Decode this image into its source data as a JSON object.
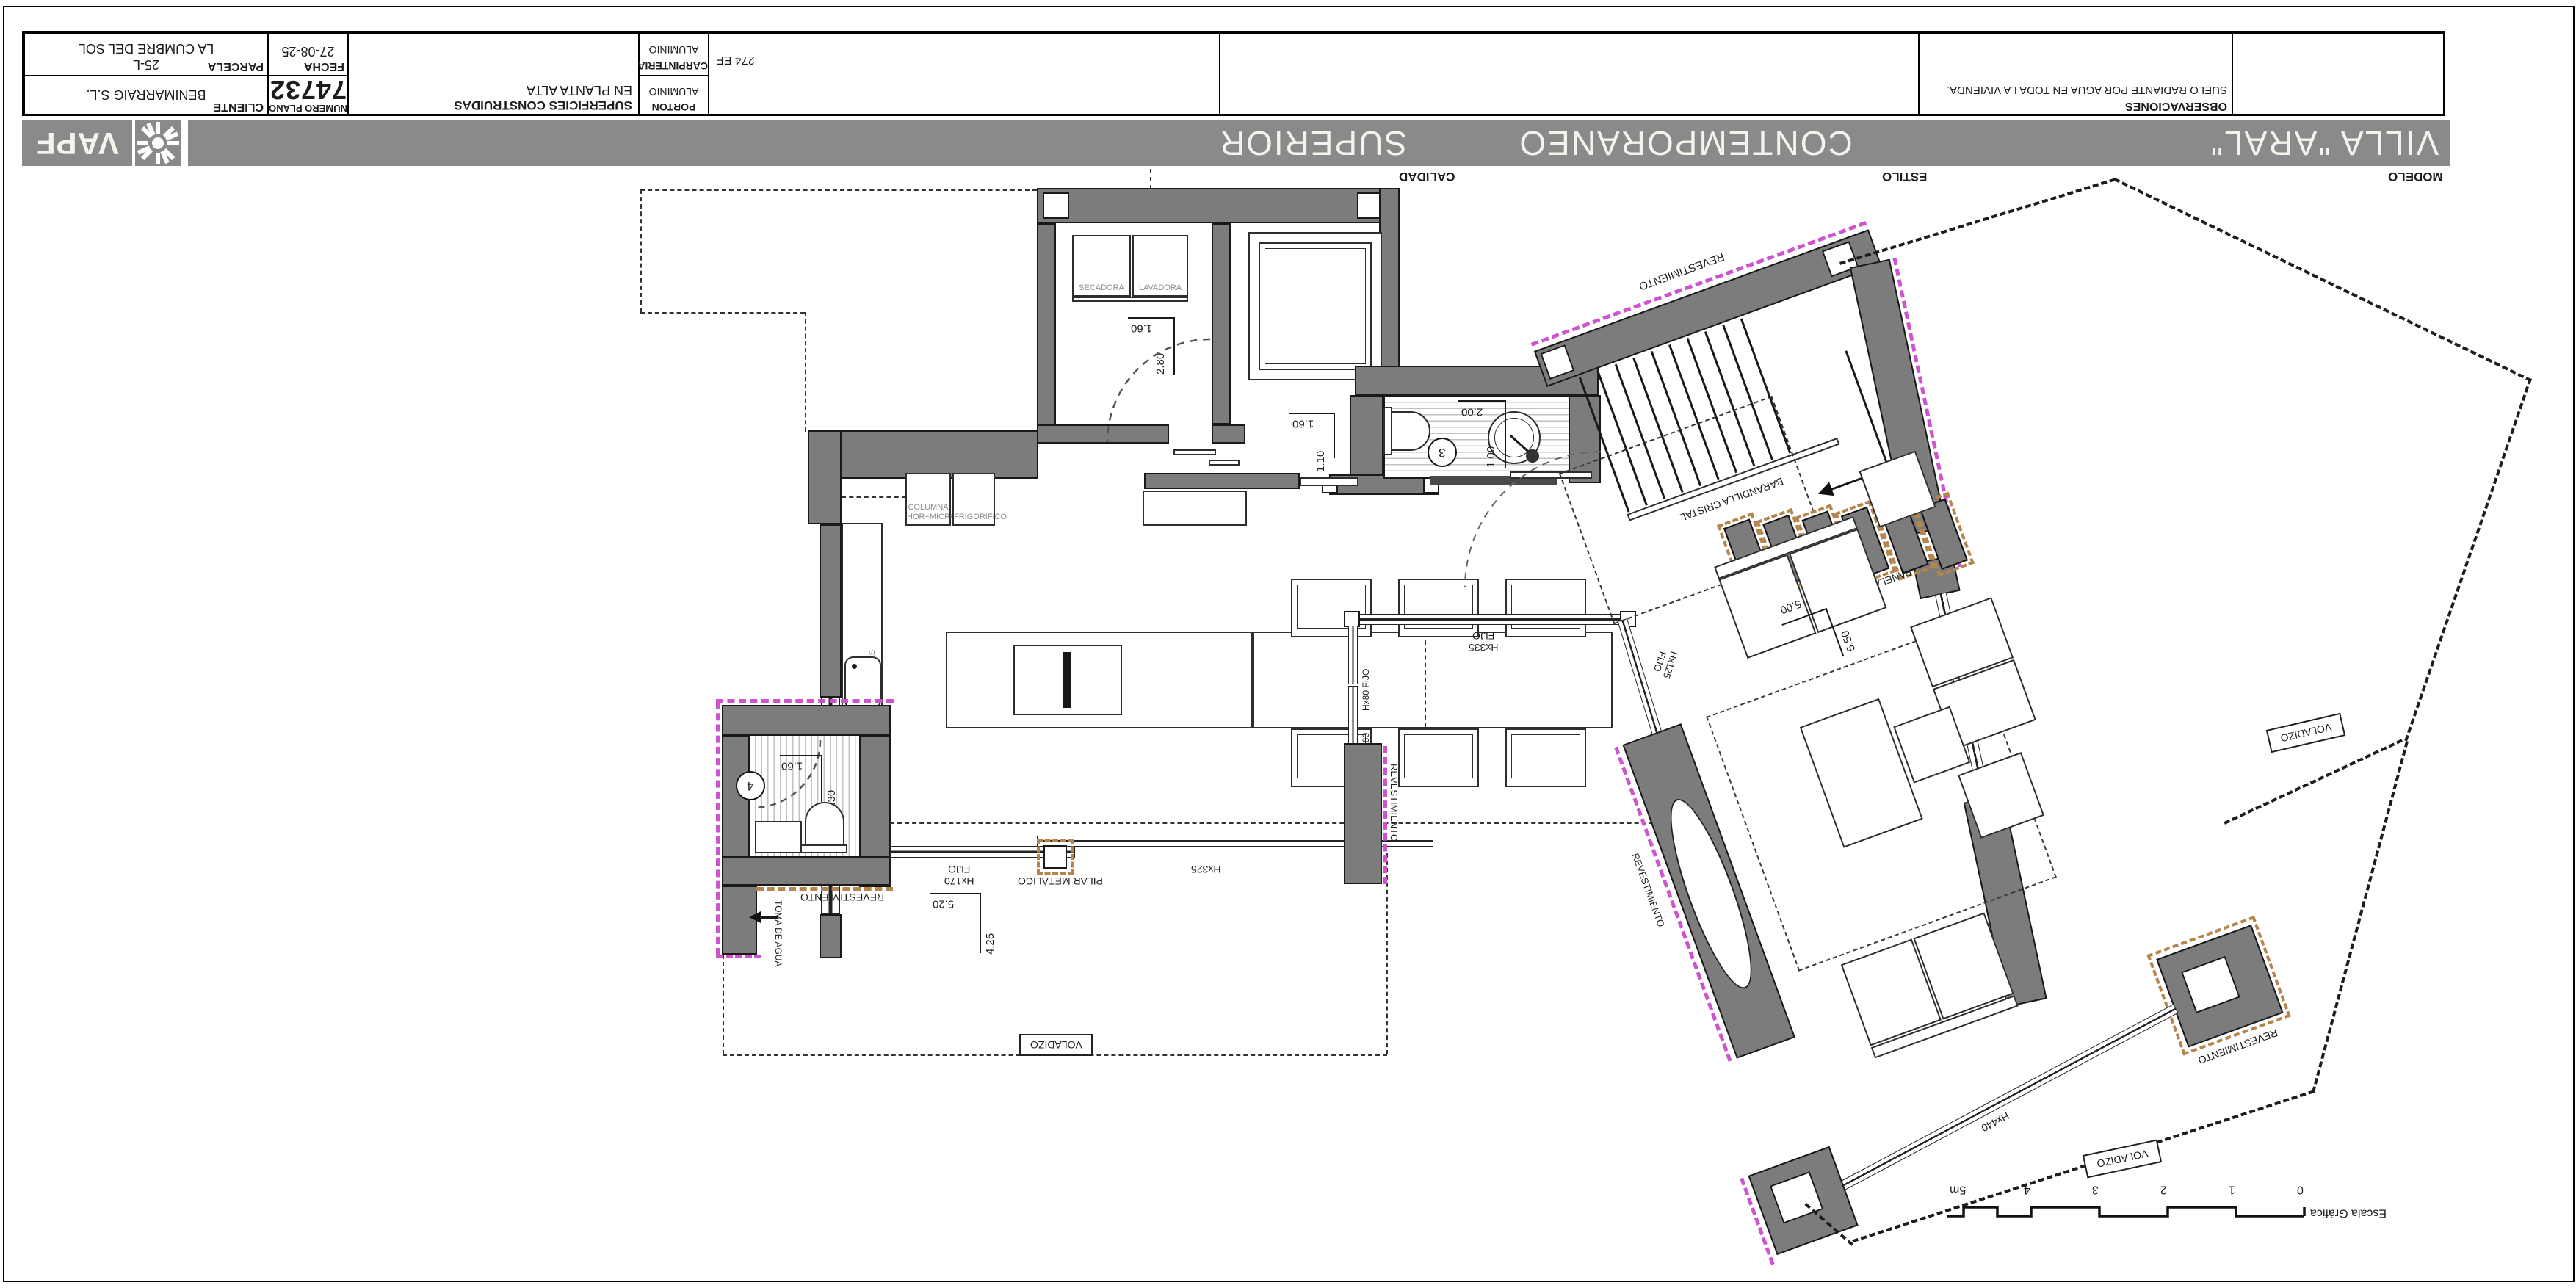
{
  "title_block": {
    "parcela": {
      "label": "PARCELA",
      "line1": "LA CUMBRE DEL SOL",
      "line2": "25-L"
    },
    "fecha": {
      "label": "FECHA",
      "value": "27-08-25"
    },
    "cliente": {
      "label": "CLIENTE",
      "value": "BENIMARRAIG S.L."
    },
    "numero_plano": {
      "label": "NUMERO PLANO",
      "value": "74732"
    },
    "superficies": {
      "line1": "SUPERFICIES CONSTRUIDAS",
      "line2": "EN PLANTA ALTA",
      "total": "274 EF"
    },
    "carpinteria": {
      "label": "CARPINTERIA",
      "value": "ALUMINIO"
    },
    "porton": {
      "label": "PORTON",
      "value": "ALUMINIO"
    },
    "observaciones": {
      "label": "OBSERVACIONES",
      "text": "SUELO RADIANTE POR AGUA EN TODA LA VIVIENDA."
    }
  },
  "brand": {
    "logo": "VAPF"
  },
  "band": {
    "modelo": {
      "label": "MODELO",
      "value": "VILLA \"ARAL\""
    },
    "estilo": {
      "label": "ESTILO",
      "value": "CONTEMPORANEO"
    },
    "calidad": {
      "label": "CALIDAD",
      "value": "SUPERIOR"
    }
  },
  "plan": {
    "rooms": {
      "secadora": "SECADORA",
      "lavadora": "LAVADORA",
      "columna_l1": "COLUMNA",
      "columna_l2": "HOR+MICRO",
      "frigorifico": "FRIGORIFICO",
      "lavavajillas": "LAVAVAJILLAS"
    },
    "labels": {
      "revestimiento": "REVESTIMIENTO",
      "barandilla": "BARANDILLA CRISTAL",
      "panelado": "PANELADO",
      "voladizo": "VOLADIZO",
      "pilar": "PILAR METÁLICO",
      "toma_agua": "TOMA DE AGUA",
      "window_size": "120x220",
      "fijo": "FIJO"
    },
    "windows": {
      "h335": "Hx335",
      "h80": "Hx80",
      "h125": "Hx125",
      "h170": "Hx170",
      "h325": "Hx325",
      "h160": "Hx160",
      "h440": "Hx440"
    },
    "dims": {
      "laundry_w": "1.60",
      "laundry_d": "2.80",
      "hall_w": "1.60",
      "hall_d": "1.10",
      "bath3_w": "2.00",
      "bath3_d": "1.00",
      "bath4_w": "1.60",
      "bath4_d": "1.30",
      "kitchen_w": "5.20",
      "kitchen_d": "4.25",
      "living_w": "5.00",
      "living_d": "5.50"
    },
    "room_numbers": {
      "bath3": "3",
      "bath4": "4"
    },
    "scale": {
      "label": "Escala Gráfica",
      "ticks": [
        "0",
        "1",
        "2",
        "3",
        "4",
        "5m"
      ]
    }
  }
}
